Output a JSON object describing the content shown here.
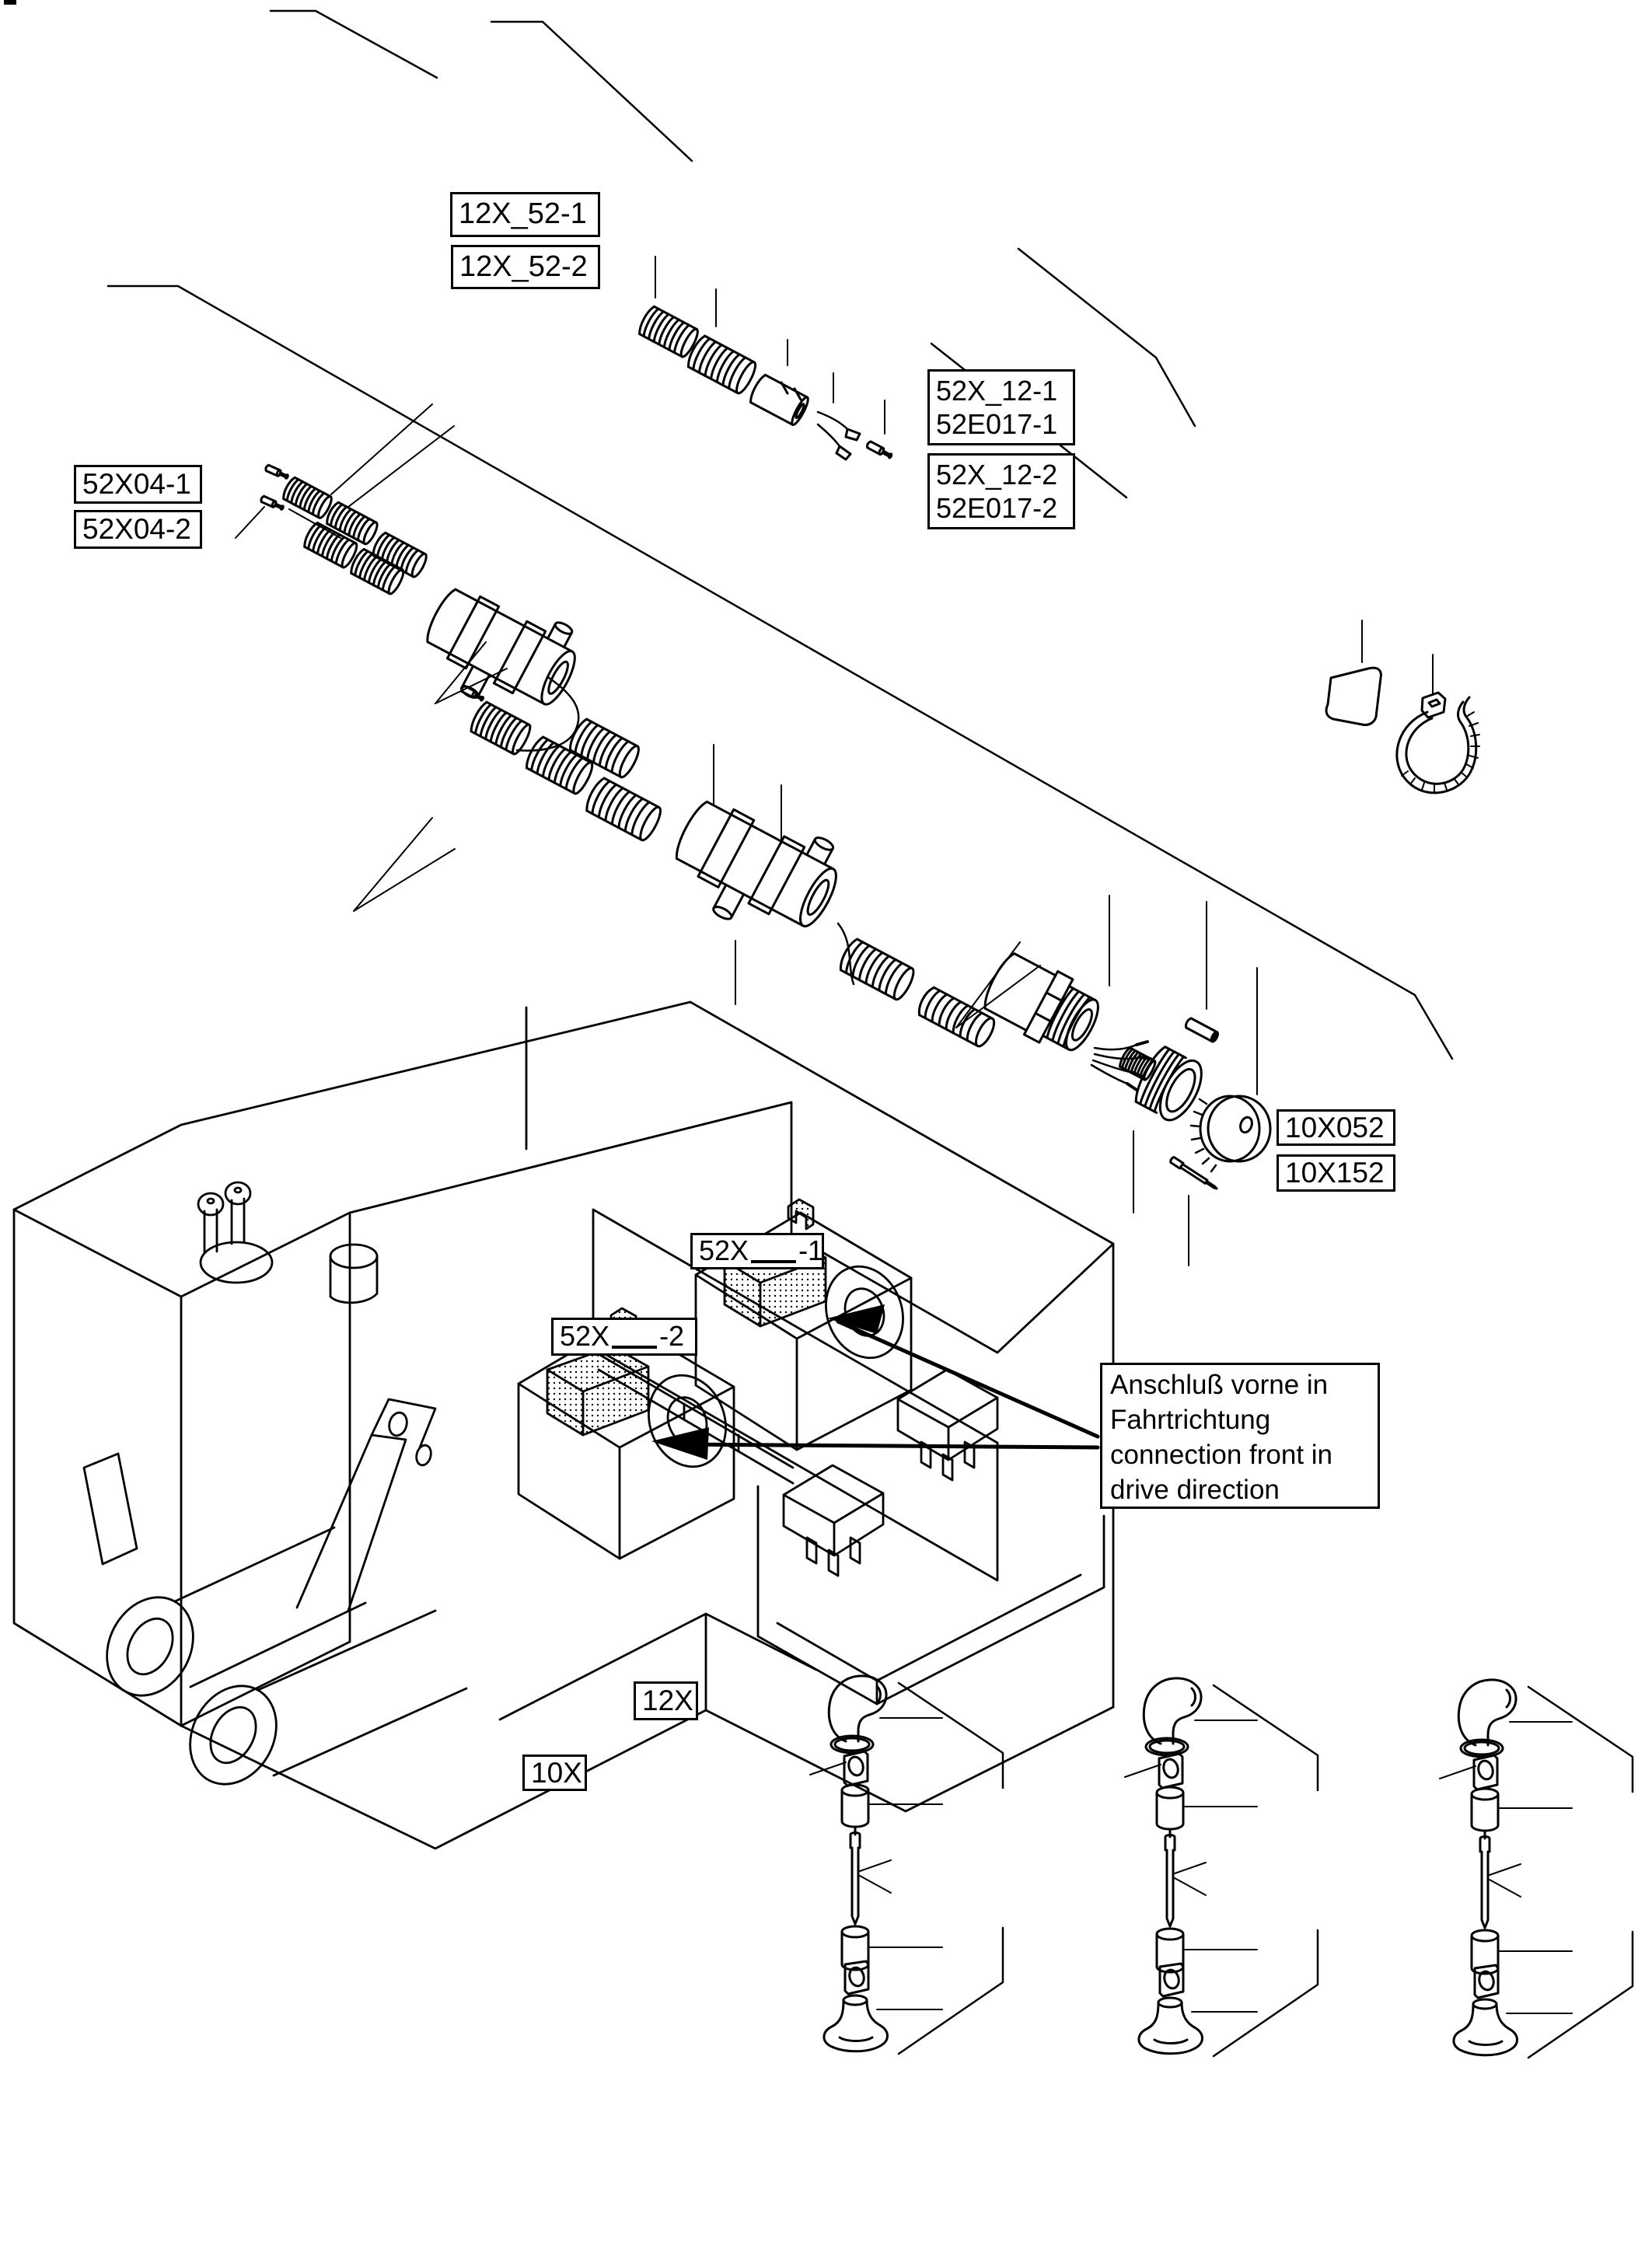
{
  "diagram": {
    "type": "exploded-parts-wiring-diagram",
    "language": "de/en"
  },
  "labels": {
    "harness_top_1": "12X_52-1",
    "harness_top_2": "12X_52-2",
    "connector_right_1a": "52X_12-1",
    "connector_right_1b": "52E017-1",
    "connector_right_2a": "52X_12-2",
    "connector_right_2b": "52E017-2",
    "sensor_left_1": "52X04-1",
    "sensor_left_2": "52X04-2",
    "plug_1": "10X052",
    "plug_2": "10X152",
    "module_1_prefix": "52X",
    "module_1_suffix": "-1",
    "module_2_prefix": "52X",
    "module_2_suffix": "-2",
    "step_upper": "12X",
    "step_lower": "10X"
  },
  "note": {
    "line1": "Anschluß vorne in",
    "line2": "Fahrtrichtung",
    "line3": "connection front in",
    "line4": "drive direction"
  },
  "colors": {
    "ink": "#000000",
    "paper": "#ffffff"
  }
}
